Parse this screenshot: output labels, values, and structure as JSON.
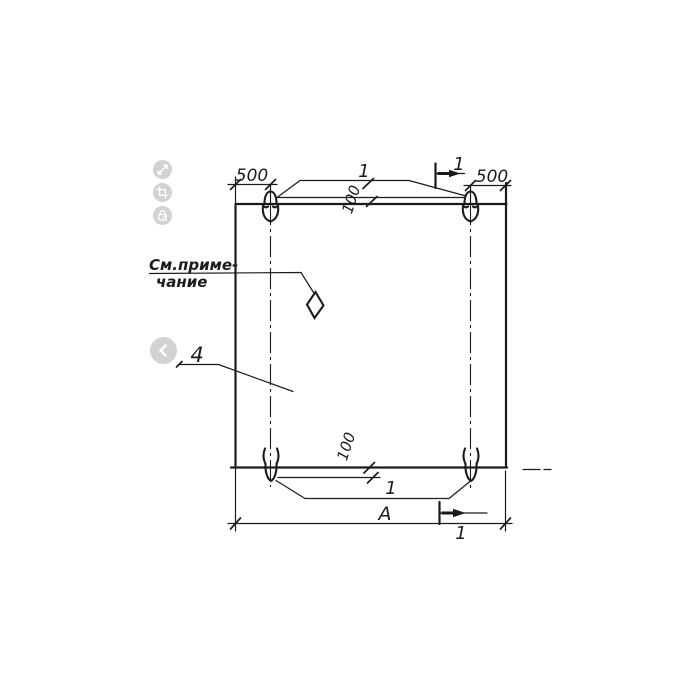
{
  "page": {
    "background": "#ffffff",
    "ink_color": "#1b1b1b",
    "button_color": "#d2d2d2",
    "button_glyph_color": "#ffffff"
  },
  "viewer_controls": {
    "buttons": [
      {
        "name": "expand",
        "icon": "expand-icon"
      },
      {
        "name": "crop",
        "icon": "crop-icon"
      },
      {
        "name": "lock",
        "icon": "lock-icon"
      },
      {
        "name": "previous",
        "icon": "chevron-left-icon"
      }
    ]
  },
  "drawing": {
    "type": "precast-panel-elevation",
    "labels": {
      "dim_top_left": "500",
      "dim_top_right": "500",
      "top_loops_callout": "1",
      "section_mark_top": "1",
      "dim_offset_top": "100",
      "note_line1": "См.приме-",
      "note_line2": "чание",
      "item_callout": "4",
      "dim_offset_bottom": "100",
      "bottom_loops_callout": "1",
      "dim_overall_width": "А",
      "section_mark_bottom": "1"
    }
  }
}
